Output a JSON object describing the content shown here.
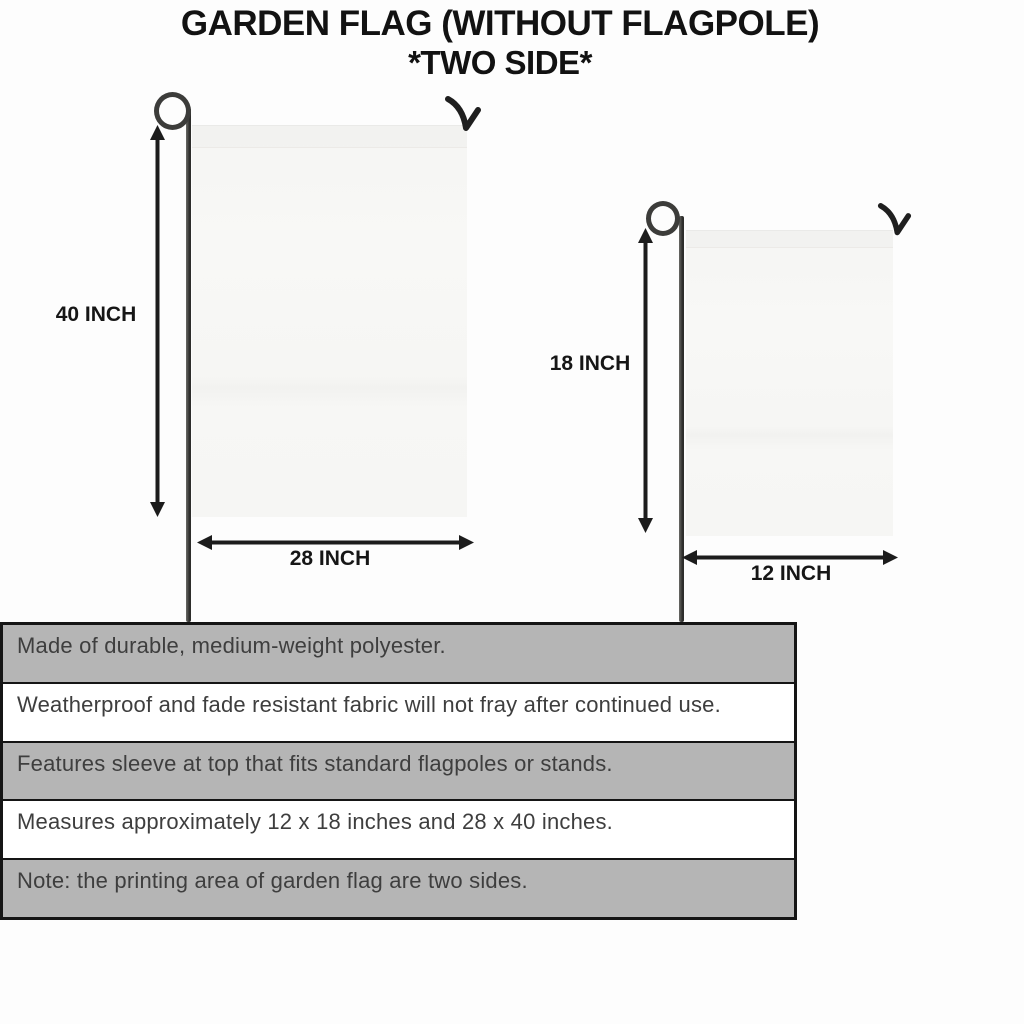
{
  "title": {
    "line1": "GARDEN FLAG (WITHOUT FLAGPOLE)",
    "line2": "*TWO SIDE*"
  },
  "flags": {
    "large": {
      "height_label": "40 INCH",
      "width_label": "28 INCH"
    },
    "small": {
      "height_label": "18 INCH",
      "width_label": "12 INCH"
    }
  },
  "specs": {
    "rows": [
      "Made of durable, medium-weight polyester.",
      "Weatherproof and fade resistant fabric will not fray after continued use.",
      "Features sleeve at top that fits standard flagpoles or stands.",
      "Measures approximately 12 x 18 inches and 28 x 40 inches.",
      "Note: the printing area of garden flag are two sides."
    ]
  },
  "colors": {
    "ink": "#161616",
    "table_row_gray": "#b5b5b5",
    "table_row_white": "#ffffff",
    "table_text": "#3e3e3e",
    "flag_fill": "#f7f7f5",
    "pole": "#3c3c3a"
  }
}
